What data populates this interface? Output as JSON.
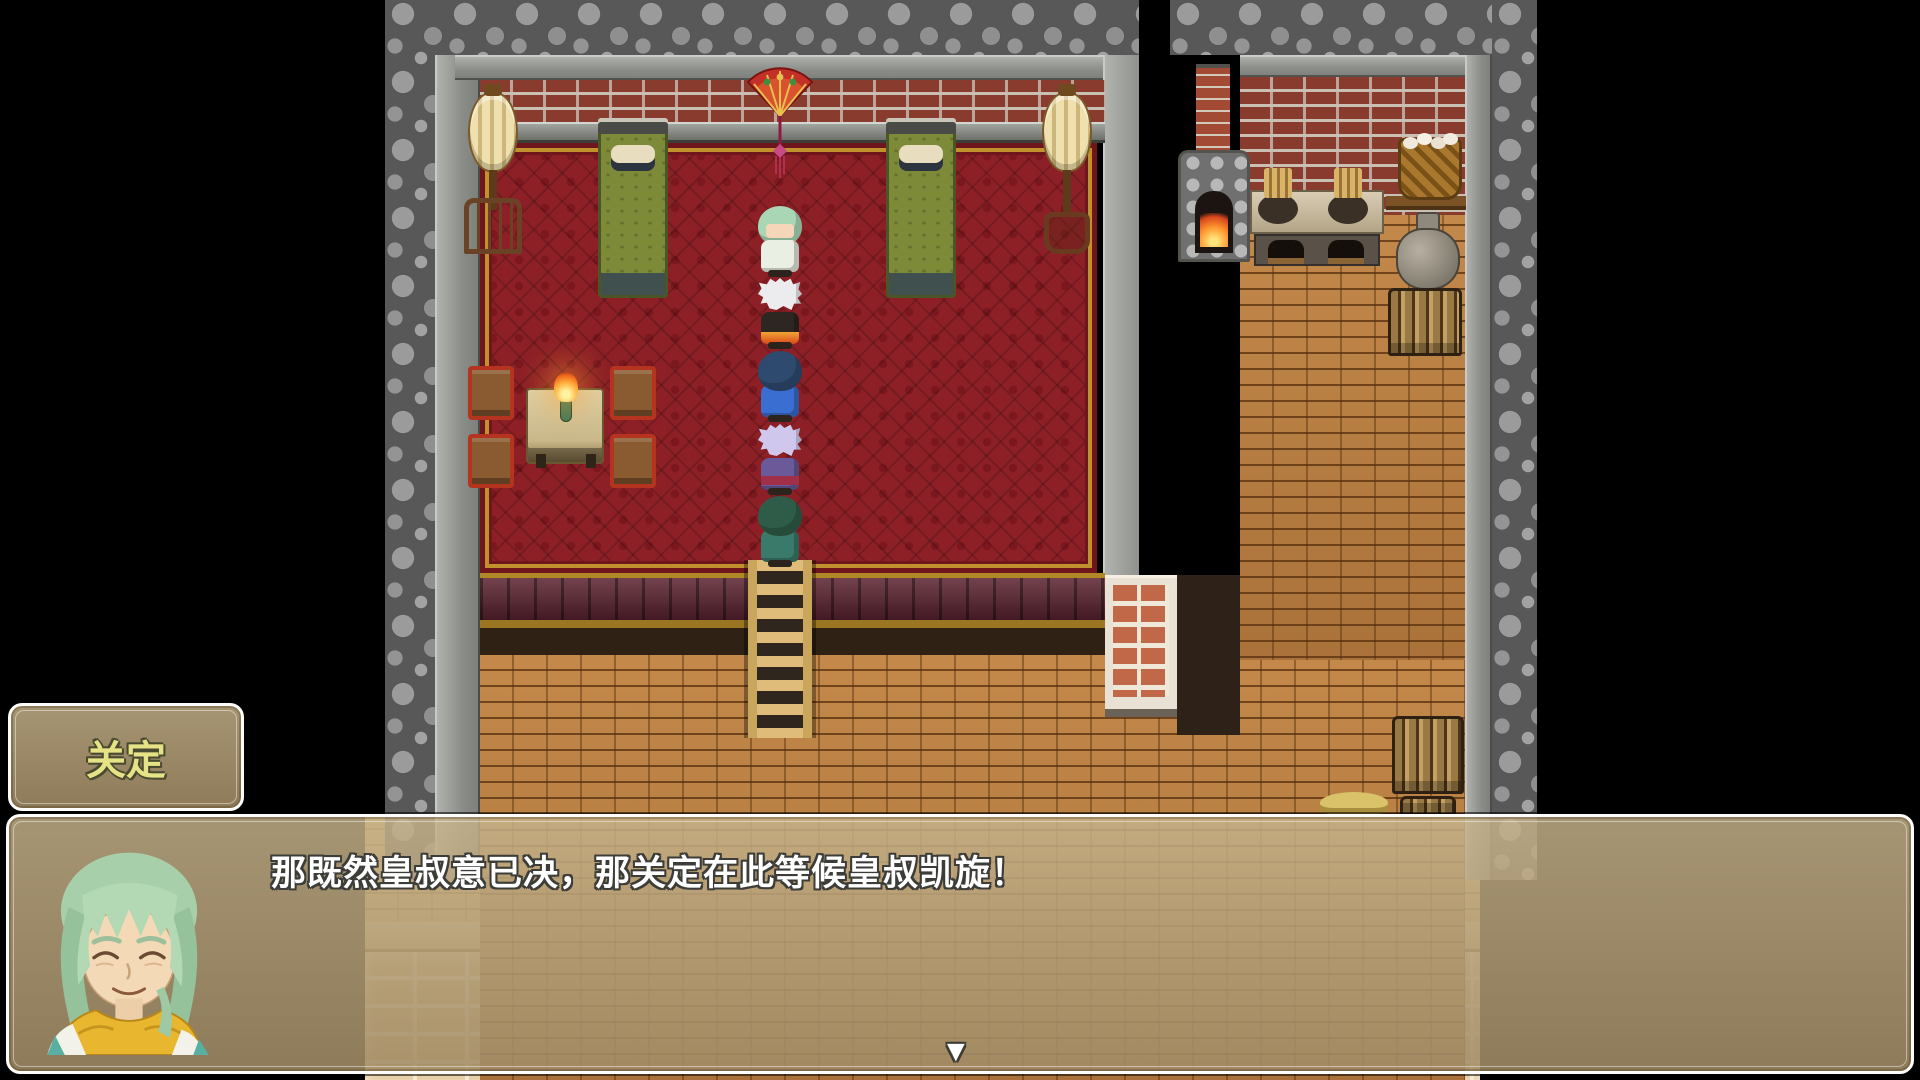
{
  "game": {
    "ui": {
      "name_box": {
        "text": "关定",
        "text_color": "#e6e387"
      },
      "message_box": {
        "text": "那既然皇叔意已决，那关定在此等候皇叔凯旋！",
        "text_color": "#ffffff",
        "speaker_portrait": "smiling old man with light green hair and yellow scarf",
        "continue_indicator": "▼"
      },
      "window": {
        "border_color": "#fcfcfa",
        "background_color": "rgba(180,158,120,0.86)"
      }
    },
    "scene": {
      "type": "rpg-interior-map",
      "rooms": [
        {
          "name": "bedroom",
          "floor": "red diamond-pattern carpet",
          "wall": "red brick over gray stone"
        },
        {
          "name": "kitchen",
          "floor": "tan brick",
          "wall": "red brick"
        }
      ],
      "party_characters": [
        {
          "position": 1,
          "facing": "down",
          "hair_color": "#a9d6b5",
          "robe_color": "#e9efe2",
          "description": "green-haired youth facing camera"
        },
        {
          "position": 2,
          "facing": "down",
          "hair_color": "#ececee",
          "robe_color": "#e8761f",
          "description": "white spiky hair, flame-hemmed robe"
        },
        {
          "position": 3,
          "facing": "up",
          "hair_color": "#2e4a6e",
          "robe_color": "#3a6ed0",
          "description": "navy-haired figure in blue robe"
        },
        {
          "position": 4,
          "facing": "up",
          "hair_color": "#cfc8ec",
          "robe_color": "#6a5a9a",
          "sash_color": "#a03048",
          "description": "lavender spiky hair, purple robe with red sash"
        },
        {
          "position": 5,
          "facing": "up",
          "hair_color": "#2f5c49",
          "robe_color": "#3a7a6a",
          "description": "dark green hair, teal outfit"
        }
      ],
      "objects": [
        "hanging-fan",
        "paper-lantern-left",
        "lantern-stand-left",
        "paper-lantern-right",
        "lantern-stand-right",
        "bed-left",
        "bed-right",
        "table",
        "torch-on-table",
        "chair x4",
        "ladder-down",
        "stone-furnace",
        "brick-chimney",
        "cooking-stove",
        "basket-of-eggs",
        "shelf-board",
        "grain-sack",
        "firewood-pile-kitchen",
        "firewood-pile-floor",
        "straw-pile",
        "plaster-brick-pillar"
      ],
      "palette": {
        "carpet": "#8c2026",
        "wall_brick": "#9c4434",
        "floor_brick": "#bd7f40",
        "cobblestone": "#8e8e8e",
        "outside": "#000000"
      }
    }
  }
}
